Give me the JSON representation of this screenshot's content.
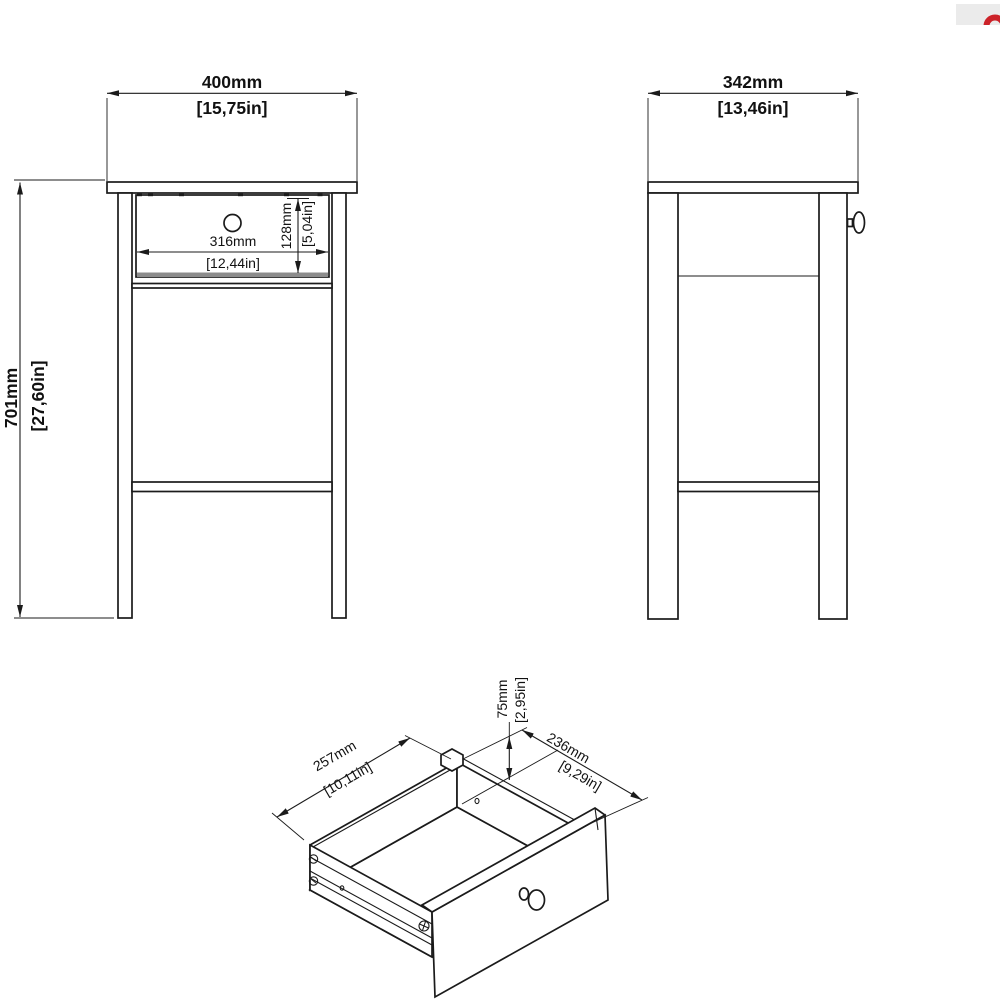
{
  "colors": {
    "line": "#1b1b1b",
    "shadow": "#8c8c8c"
  },
  "logo": {
    "bg_color": "#ebebeb",
    "accent_color": "#cc2229"
  },
  "front_view": {
    "width_dim": {
      "mm": "400mm",
      "inches": "[15,75in]"
    },
    "height_dim": {
      "mm": "701mm",
      "inches": "[27,60in]"
    },
    "drawer_width_dim": {
      "mm": "316mm",
      "inches": "[12,44in]"
    },
    "drawer_height_dim": {
      "mm": "128mm",
      "inches": "[5,04in]"
    }
  },
  "side_view": {
    "depth_dim": {
      "mm": "342mm",
      "inches": "[13,46in]"
    }
  },
  "drawer_view": {
    "width_dim": {
      "mm": "257mm",
      "inches": "[10,11in]"
    },
    "depth_dim": {
      "mm": "236mm",
      "inches": "[9,29in]"
    },
    "height_dim": {
      "mm": "75mm",
      "inches": "[2,95in]"
    }
  }
}
